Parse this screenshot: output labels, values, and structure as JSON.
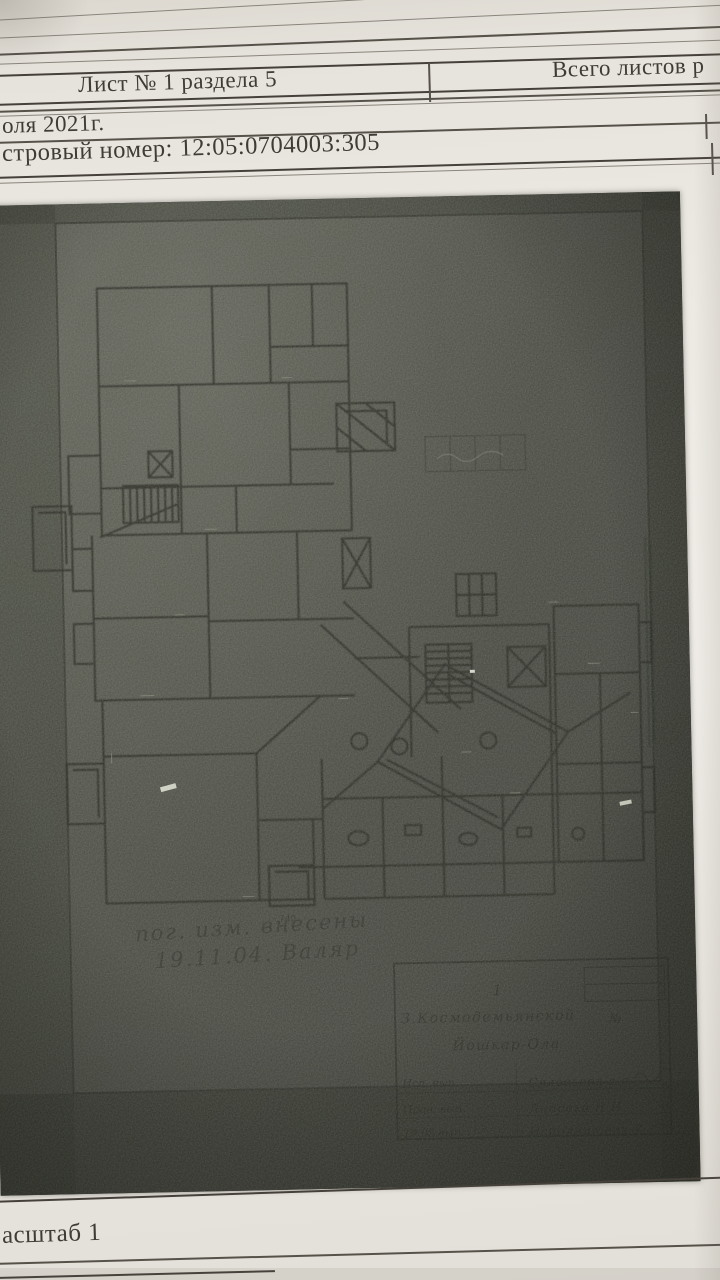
{
  "header": {
    "sheet_label": "Лист № 1 раздела 5",
    "total_sheets_label": "Всего листов р",
    "date_line": "оля 2021г.",
    "cadastral_line": "стровый номер: 12:05:0704003:305"
  },
  "plan": {
    "porch_dim": "740",
    "note_line1": "пог. изм. внесены",
    "note_line2": "19.11.04.  Валяр",
    "stamp": {
      "fig_no": "1",
      "line1": "З.Космодемьянской",
      "line1_no": "№",
      "line2": "Йошкар-Ола",
      "rows": [
        {
          "label": "Исп. вып.",
          "value": "Соловьева а.о."
        },
        {
          "label": "Пров. вып.",
          "value": "Липовка Н.Н."
        },
        {
          "label": "19.08 вып.",
          "value": "Исполнитель У."
        }
      ]
    }
  },
  "footer": {
    "scale_label": "асштаб 1"
  },
  "colors": {
    "paper": "#edeae4",
    "plan_background": "#45463f",
    "ink": "#3a3833"
  }
}
